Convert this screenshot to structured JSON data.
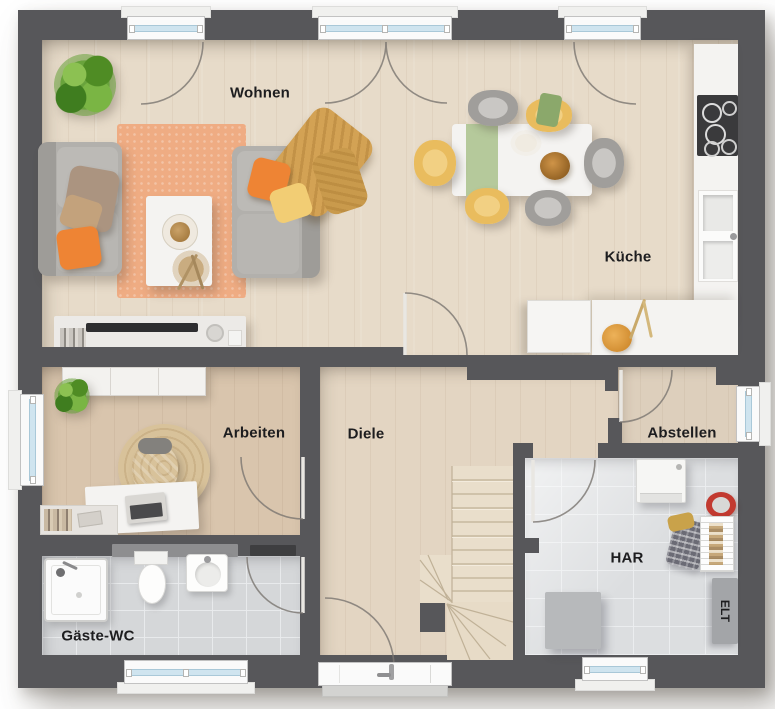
{
  "plan": {
    "rooms": {
      "wohnen": {
        "label": "Wohnen"
      },
      "kueche": {
        "label": "Küche"
      },
      "arbeiten": {
        "label": "Arbeiten"
      },
      "diele": {
        "label": "Diele"
      },
      "abstellen": {
        "label": "Abstellen"
      },
      "har": {
        "label": "HAR"
      },
      "gaeste_wc": {
        "label": "Gäste-WC"
      },
      "elt": {
        "label": "ELT"
      }
    },
    "palette": {
      "wall": "#57575a",
      "floor-wood": "#e7dbc9",
      "floor-wood-warm": "#d9c5ad",
      "floor-wood-hall": "#e3d5c2",
      "floor-tile": "#d5d7d9",
      "floor-tile-har": "#dcdee0",
      "counter": "#f4f3f1",
      "rug": "#efac83",
      "rug-round": "#d8c29a",
      "sofa": "#b2b0ac",
      "pillow-orange": "#ee8434",
      "pillow-yellow": "#f2cd74",
      "throw-mustard": "#d3a254",
      "chair-yellow": "#e9bc5e",
      "plant-green": "#69a33c",
      "glass": "#cfe4ef",
      "label-ink": "#1d1d1f"
    }
  }
}
